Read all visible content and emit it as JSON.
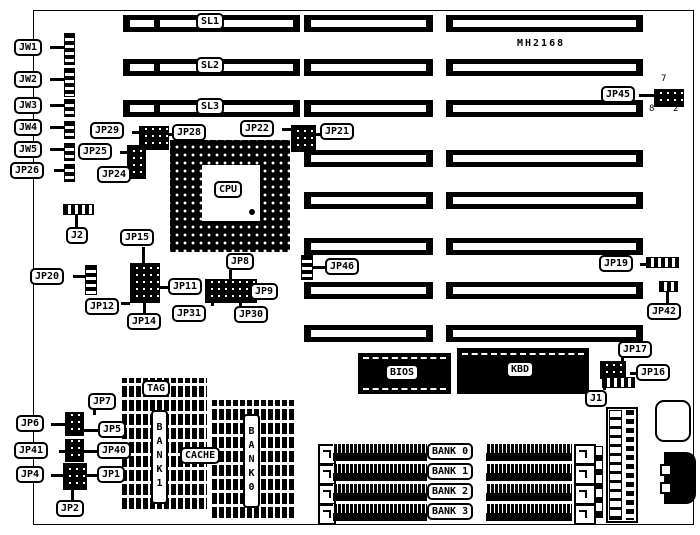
{
  "title": "MH2168",
  "slots": {
    "sl1": "SL1",
    "sl2": "SL2",
    "sl3": "SL3"
  },
  "cpu": {
    "label": "CPU"
  },
  "chips": {
    "bios": "BIOS",
    "kbd": "KBD"
  },
  "cache": {
    "tag": "TAG",
    "cache": "CACHE",
    "bank1": "BANK1",
    "bank0": "BANK0"
  },
  "memory": {
    "bank0": "BANK 0",
    "bank1": "BANK 1",
    "bank2": "BANK 2",
    "bank3": "BANK 3"
  },
  "jp45_pins": {
    "p7": "7",
    "p8": "8",
    "p2": "2"
  },
  "jumpers": {
    "JW1": "JW1",
    "JW2": "JW2",
    "JW3": "JW3",
    "JW4": "JW4",
    "JW5": "JW5",
    "JP26": "JP26",
    "J2": "J2",
    "JP20": "JP20",
    "JP29": "JP29",
    "JP28": "JP28",
    "JP25": "JP25",
    "JP24": "JP24",
    "JP22": "JP22",
    "JP21": "JP21",
    "JP45": "JP45",
    "JP15": "JP15",
    "JP12": "JP12",
    "JP14": "JP14",
    "JP11": "JP11",
    "JP31": "JP31",
    "JP8": "JP8",
    "JP9": "JP9",
    "JP30": "JP30",
    "JP46": "JP46",
    "JP19": "JP19",
    "JP42": "JP42",
    "JP17": "JP17",
    "JP16": "JP16",
    "J1": "J1",
    "JP7": "JP7",
    "JP6": "JP6",
    "JP5": "JP5",
    "JP41": "JP41",
    "JP40": "JP40",
    "JP4": "JP4",
    "JP1": "JP1",
    "JP2": "JP2"
  }
}
